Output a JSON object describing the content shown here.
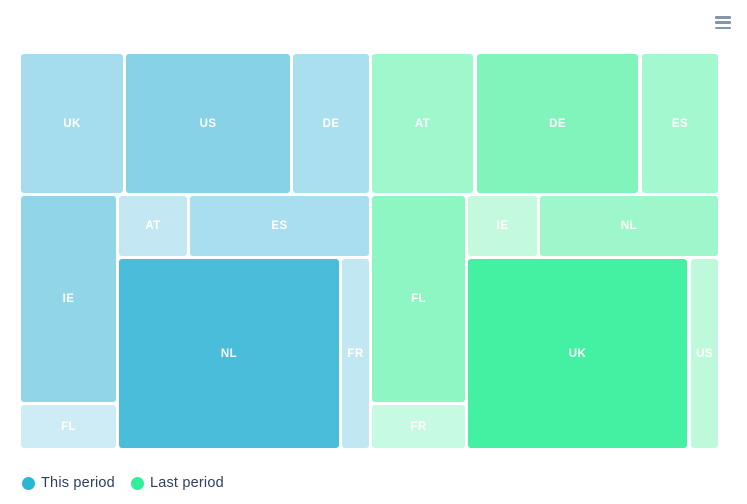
{
  "chart_data": {
    "type": "treemap",
    "title": "",
    "frame": {
      "w": 699,
      "h": 396
    },
    "legend_position": "bottom-left",
    "groups": [
      {
        "name": "This period",
        "key": "this-period",
        "accent_color": "#2ab7d2",
        "tiles": [
          {
            "label": "UK",
            "share_pct": 10.7,
            "color": "#a5ddee",
            "x": 1,
            "y": 1,
            "w": 102,
            "h": 139
          },
          {
            "label": "US",
            "share_pct": 17.2,
            "color": "#87d2e6",
            "x": 106,
            "y": 1,
            "w": 164,
            "h": 139
          },
          {
            "label": "DE",
            "share_pct": 8.0,
            "color": "#aadff0",
            "x": 273,
            "y": 1,
            "w": 76,
            "h": 139
          },
          {
            "label": "IE",
            "share_pct": 14.7,
            "color": "#90d6e8",
            "x": 1,
            "y": 143,
            "w": 95,
            "h": 206
          },
          {
            "label": "AT",
            "share_pct": 3.1,
            "color": "#c3e8f3",
            "x": 99,
            "y": 143,
            "w": 68,
            "h": 60
          },
          {
            "label": "ES",
            "share_pct": 8.1,
            "color": "#a9def0",
            "x": 170,
            "y": 143,
            "w": 179,
            "h": 60
          },
          {
            "label": "NL",
            "share_pct": 31.0,
            "color": "#49bdd9",
            "x": 99,
            "y": 206,
            "w": 220,
            "h": 189
          },
          {
            "label": "FR",
            "share_pct": 3.9,
            "color": "#c1e7f2",
            "x": 322,
            "y": 206,
            "w": 27,
            "h": 189
          },
          {
            "label": "FL",
            "share_pct": 3.1,
            "color": "#cdecf6",
            "x": 1,
            "y": 352,
            "w": 95,
            "h": 43
          }
        ]
      },
      {
        "name": "Last period",
        "key": "last-period",
        "accent_color": "#2ff098",
        "tiles": [
          {
            "label": "AT",
            "share_pct": 10.5,
            "color": "#9ff8cc",
            "x": 352,
            "y": 1,
            "w": 101,
            "h": 139
          },
          {
            "label": "DE",
            "share_pct": 16.8,
            "color": "#80f4bb",
            "x": 457,
            "y": 1,
            "w": 161,
            "h": 139
          },
          {
            "label": "ES",
            "share_pct": 8.0,
            "color": "#a3f8cf",
            "x": 622,
            "y": 1,
            "w": 76,
            "h": 139
          },
          {
            "label": "FL",
            "share_pct": 14.4,
            "color": "#8df6c2",
            "x": 352,
            "y": 143,
            "w": 93,
            "h": 206
          },
          {
            "label": "IE",
            "share_pct": 3.1,
            "color": "#c3fade",
            "x": 448,
            "y": 143,
            "w": 69,
            "h": 60
          },
          {
            "label": "NL",
            "share_pct": 8.1,
            "color": "#9ef7cb",
            "x": 520,
            "y": 143,
            "w": 178,
            "h": 60
          },
          {
            "label": "UK",
            "share_pct": 30.9,
            "color": "#44f1a3",
            "x": 448,
            "y": 206,
            "w": 219,
            "h": 189
          },
          {
            "label": "US",
            "share_pct": 3.9,
            "color": "#bff9dc",
            "x": 671,
            "y": 206,
            "w": 27,
            "h": 189
          },
          {
            "label": "FR",
            "share_pct": 3.1,
            "color": "#c7fae3",
            "x": 352,
            "y": 352,
            "w": 93,
            "h": 43
          }
        ]
      }
    ]
  },
  "legend": {
    "items": [
      {
        "label": "This period",
        "color": "#2ab7d2"
      },
      {
        "label": "Last period",
        "color": "#2ff098"
      }
    ]
  },
  "menu": {
    "icon": "hamburger-icon"
  }
}
